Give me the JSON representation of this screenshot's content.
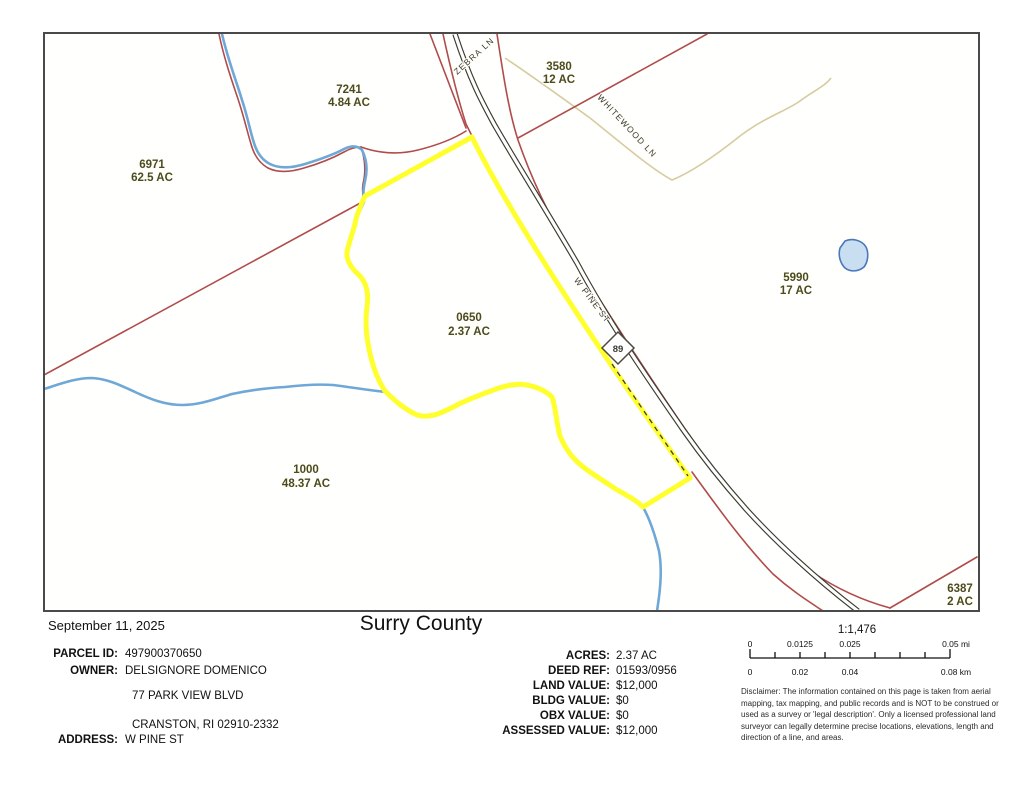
{
  "map": {
    "route_shield": "89",
    "streets": [
      {
        "name": "ZEBRA LN"
      },
      {
        "name": "WHITEWOOD LN"
      },
      {
        "name": "W PINE ST"
      }
    ],
    "parcels": [
      {
        "id": "7241",
        "acres": "4.84 AC"
      },
      {
        "id": "3580",
        "acres": "12 AC"
      },
      {
        "id": "6971",
        "acres": "62.5 AC"
      },
      {
        "id": "5990",
        "acres": "17 AC"
      },
      {
        "id": "0650",
        "acres": "2.37 AC"
      },
      {
        "id": "1000",
        "acres": "48.37 AC"
      },
      {
        "id": "6387",
        "acres": "2 AC"
      }
    ],
    "colors": {
      "highlight_yellow": "#FFFF2E",
      "parcel_line_red": "#B04C4C",
      "stream_blue": "#6FA8D6",
      "road_dark": "#3B3B31",
      "minor_road_tan": "#D8CBA0",
      "label_olive": "#4B4B22",
      "pond_fill": "#C9DEF1",
      "pond_stroke": "#4A78B8"
    }
  },
  "footer": {
    "date": "September 11, 2025",
    "title": "Surry County",
    "info": {
      "parcel_id_label": "PARCEL ID:",
      "parcel_id": "497900370650",
      "owner_label": "OWNER:",
      "owner": "DELSIGNORE DOMENICO",
      "owner_addr1": "77 PARK VIEW BLVD",
      "owner_addr2": "CRANSTON, RI 02910-2332",
      "address_label": "ADDRESS:",
      "address": "W PINE ST"
    },
    "values": [
      {
        "label": "ACRES:",
        "value": "2.37 AC"
      },
      {
        "label": "DEED REF:",
        "value": "01593/0956"
      },
      {
        "label": "LAND VALUE:",
        "value": "$12,000"
      },
      {
        "label": "BLDG VALUE:",
        "value": "$0"
      },
      {
        "label": "OBX VALUE:",
        "value": "$0"
      },
      {
        "label": "ASSESSED VALUE:",
        "value": "$12,000"
      }
    ],
    "scale": {
      "ratio": "1:1,476",
      "mi": [
        "0",
        "0.0125",
        "0.025",
        "0.05 mi"
      ],
      "km": [
        "0",
        "0.02",
        "0.04",
        "0.08 km"
      ]
    },
    "disclaimer": "Disclaimer: The information contained on this page is taken from aerial mapping, tax mapping, and public records and is NOT to be construed or used as a survey or 'legal description'. Only a licensed professional land surveyor can legally determine precise locations, elevations, length and direction of a line, and areas."
  }
}
